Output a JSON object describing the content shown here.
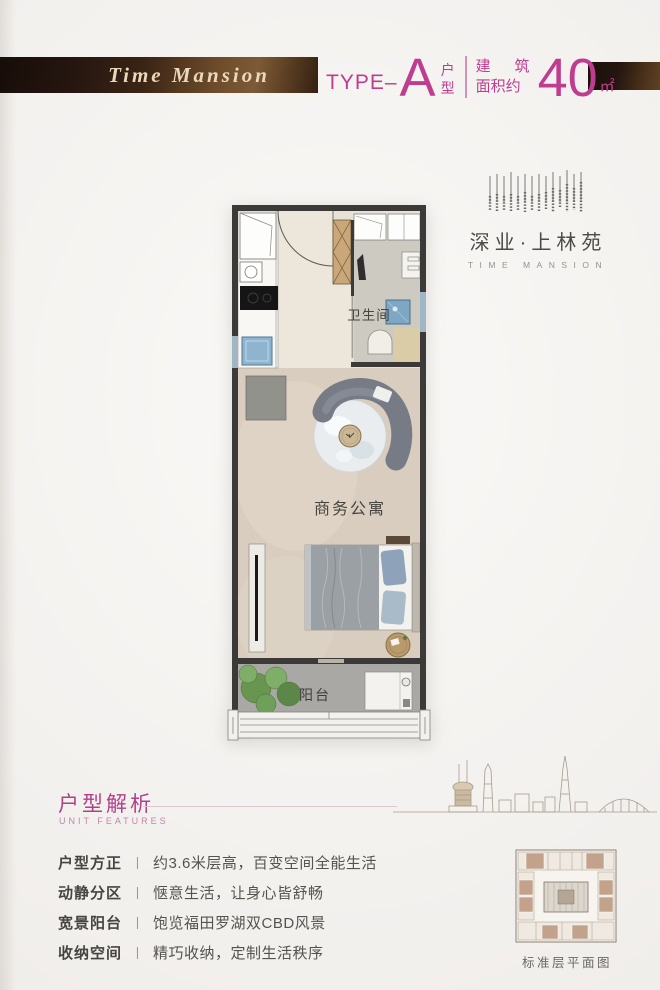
{
  "header": {
    "ribbon_text": "Time Mansion",
    "type_prefix": "TYPE–",
    "type_letter": "A",
    "type_char_top": "户",
    "type_char_bottom": "型",
    "area_char_1": "建",
    "area_char_2": "筑",
    "area_row2": "面积约",
    "area_value": "40",
    "area_unit": "㎡"
  },
  "brand": {
    "name_cn": "深业·上林苑",
    "name_en": "TIME MANSION"
  },
  "floorplan": {
    "room_bathroom": "卫生间",
    "room_living": "商务公寓",
    "room_balcony": "阳台"
  },
  "features": {
    "title_cn": "户型解析",
    "title_en": "UNIT FEATURES",
    "divider": "丨",
    "items": [
      {
        "label": "户型方正",
        "desc": "约3.6米层高，百变空间全能生活"
      },
      {
        "label": "动静分区",
        "desc": "惬意生活，让身心皆舒畅"
      },
      {
        "label": "宽景阳台",
        "desc": "饱览福田罗湖双CBD风景"
      },
      {
        "label": "收纳空间",
        "desc": "精巧收纳，定制生活秩序"
      }
    ]
  },
  "floorplate": {
    "caption": "标准层平面图"
  },
  "colors": {
    "accent": "#bf3d90",
    "ribbon_dark": "#241510",
    "ribbon_light": "#7d5a36",
    "floor_beige": "#d8cdbe",
    "fixture_blue": "#7ea7c6"
  }
}
